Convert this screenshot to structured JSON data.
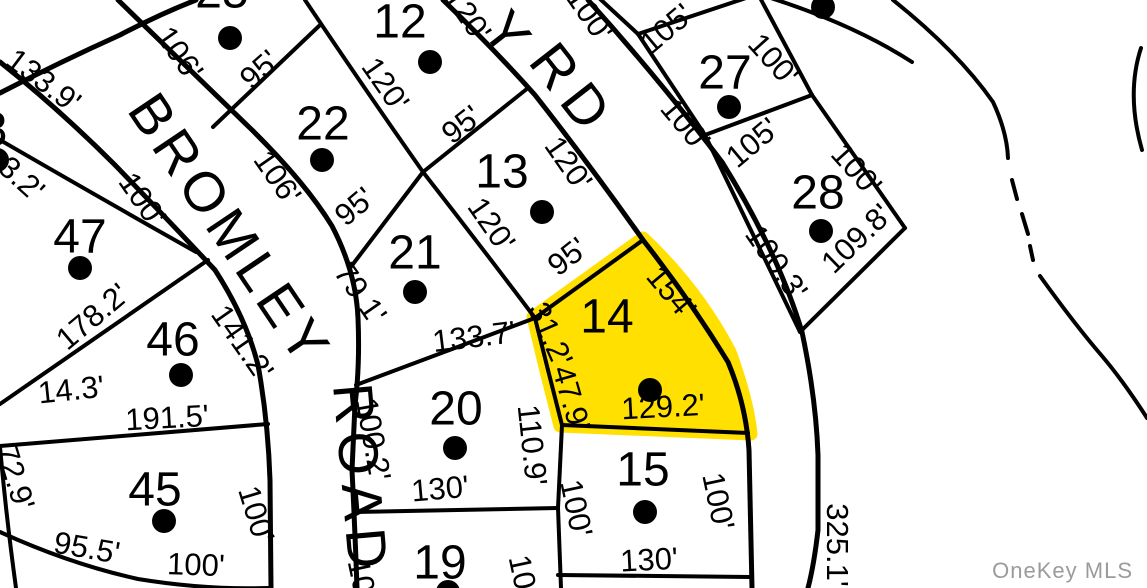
{
  "map": {
    "type": "plat-map",
    "highlighted_lot": "14",
    "colors": {
      "highlight": "#FFE000",
      "line": "#000000",
      "watermark": "#9B9B9B",
      "background": "#FFFFFF"
    }
  },
  "roads": [
    {
      "id": "bromley",
      "name": "BROMLEY",
      "x": 126,
      "y": 110,
      "rot": 56,
      "ls": 6
    },
    {
      "id": "road",
      "name": "ROAD",
      "x": 333,
      "y": 385,
      "rot": 85,
      "ls": 8
    },
    {
      "id": "rd-y",
      "name": "Y",
      "x": 480,
      "y": 30,
      "rot": 52,
      "ls": 10
    },
    {
      "id": "rd",
      "name": "RD",
      "x": 527,
      "y": 62,
      "rot": 52,
      "ls": 10
    }
  ],
  "lots": [
    {
      "number": "8",
      "nx": -6,
      "ny": 128,
      "dx": -3,
      "dy": 160
    },
    {
      "number": "12",
      "nx": 400,
      "ny": 20,
      "dx": 430,
      "dy": 62
    },
    {
      "number": "13",
      "nx": 502,
      "ny": 170,
      "dx": 542,
      "dy": 212
    },
    {
      "number": "14",
      "nx": 607,
      "ny": 315,
      "dx": 650,
      "dy": 390,
      "highlighted": true
    },
    {
      "number": "15",
      "nx": 643,
      "ny": 468,
      "dx": 645,
      "dy": 512
    },
    {
      "number": "19",
      "nx": 440,
      "ny": 561,
      "dx": 448,
      "dy": 592
    },
    {
      "number": "20",
      "nx": 456,
      "ny": 407,
      "dx": 455,
      "dy": 448
    },
    {
      "number": "21",
      "nx": 415,
      "ny": 251,
      "dx": 415,
      "dy": 292
    },
    {
      "number": "22",
      "nx": 323,
      "ny": 122,
      "dx": 322,
      "dy": 160
    },
    {
      "number": "25",
      "nx": 222,
      "ny": -10,
      "dx": 230,
      "dy": 38
    },
    {
      "number": "",
      "nx": 0,
      "ny": 0,
      "dx": 823,
      "dy": 7
    },
    {
      "number": "27",
      "nx": 725,
      "ny": 71,
      "dx": 729,
      "dy": 107
    },
    {
      "number": "28",
      "nx": 818,
      "ny": 191,
      "dx": 821,
      "dy": 231
    },
    {
      "number": "45",
      "nx": 155,
      "ny": 488,
      "dx": 164,
      "dy": 521
    },
    {
      "number": "46",
      "nx": 173,
      "ny": 338,
      "dx": 181,
      "dy": 375
    },
    {
      "number": "47",
      "nx": 80,
      "ny": 235,
      "dx": 80,
      "dy": 268
    }
  ],
  "dimensions": [
    {
      "text": "133.9'",
      "x": 44,
      "y": 80,
      "rot": 37
    },
    {
      "text": "3.2'",
      "x": 22,
      "y": 178,
      "rot": 42
    },
    {
      "text": "106'",
      "x": 180,
      "y": 53,
      "rot": 55
    },
    {
      "text": "95'",
      "x": 259,
      "y": 69,
      "rot": -42
    },
    {
      "text": "120'",
      "x": 468,
      "y": 14,
      "rot": 55
    },
    {
      "text": "120'",
      "x": 386,
      "y": 84,
      "rot": 55
    },
    {
      "text": "95'",
      "x": 461,
      "y": 124,
      "rot": -38
    },
    {
      "text": "106'",
      "x": 278,
      "y": 177,
      "rot": 55
    },
    {
      "text": "95'",
      "x": 354,
      "y": 206,
      "rot": -40
    },
    {
      "text": "120'",
      "x": 492,
      "y": 224,
      "rot": 55
    },
    {
      "text": "120'",
      "x": 569,
      "y": 163,
      "rot": 55
    },
    {
      "text": "95'",
      "x": 567,
      "y": 256,
      "rot": -38
    },
    {
      "text": "79.1'",
      "x": 361,
      "y": 293,
      "rot": 55
    },
    {
      "text": "133.7'",
      "x": 474,
      "y": 336,
      "rot": -7
    },
    {
      "text": "100'",
      "x": 143,
      "y": 199,
      "rot": 55
    },
    {
      "text": "178.2'",
      "x": 92,
      "y": 316,
      "rot": -40
    },
    {
      "text": "141.2'",
      "x": 243,
      "y": 342,
      "rot": 55
    },
    {
      "text": "14.3'",
      "x": 71,
      "y": 389,
      "rot": -6
    },
    {
      "text": "191.5'",
      "x": 167,
      "y": 417,
      "rot": -3
    },
    {
      "text": "100.2'",
      "x": 374,
      "y": 439,
      "rot": 80
    },
    {
      "text": "110.9'",
      "x": 533,
      "y": 445,
      "rot": 84
    },
    {
      "text": "130'",
      "x": 440,
      "y": 488,
      "rot": -5
    },
    {
      "text": "154'",
      "x": 672,
      "y": 292,
      "rot": 50
    },
    {
      "text": "31.2'",
      "x": 551,
      "y": 334,
      "rot": 66
    },
    {
      "text": "47.9'",
      "x": 572,
      "y": 398,
      "rot": 74
    },
    {
      "text": "129.2'",
      "x": 663,
      "y": 406,
      "rot": -3
    },
    {
      "text": "100'",
      "x": 590,
      "y": 14,
      "rot": 55
    },
    {
      "text": "105'",
      "x": 666,
      "y": 28,
      "rot": -40
    },
    {
      "text": "100'",
      "x": 774,
      "y": 59,
      "rot": 48
    },
    {
      "text": "100'",
      "x": 686,
      "y": 124,
      "rot": 50
    },
    {
      "text": "105'",
      "x": 752,
      "y": 142,
      "rot": -40
    },
    {
      "text": "100'",
      "x": 857,
      "y": 169,
      "rot": 48
    },
    {
      "text": "100.3'",
      "x": 777,
      "y": 262,
      "rot": 55
    },
    {
      "text": "109.8'",
      "x": 856,
      "y": 238,
      "rot": -44
    },
    {
      "text": "100'",
      "x": 577,
      "y": 508,
      "rot": 78
    },
    {
      "text": "100'",
      "x": 719,
      "y": 501,
      "rot": 78
    },
    {
      "text": "130'",
      "x": 649,
      "y": 559,
      "rot": -3
    },
    {
      "text": "10",
      "x": 362,
      "y": 576,
      "rot": 78
    },
    {
      "text": "10",
      "x": 523,
      "y": 572,
      "rot": 78
    },
    {
      "text": "72.9'",
      "x": 16,
      "y": 477,
      "rot": 73
    },
    {
      "text": "95.5'",
      "x": 87,
      "y": 547,
      "rot": 10
    },
    {
      "text": "100'",
      "x": 196,
      "y": 564,
      "rot": 2
    },
    {
      "text": "100'",
      "x": 257,
      "y": 514,
      "rot": 73
    },
    {
      "text": "325.1'",
      "x": 838,
      "y": 545,
      "rot": 90
    }
  ],
  "watermark": {
    "text": "OneKey MLS"
  }
}
